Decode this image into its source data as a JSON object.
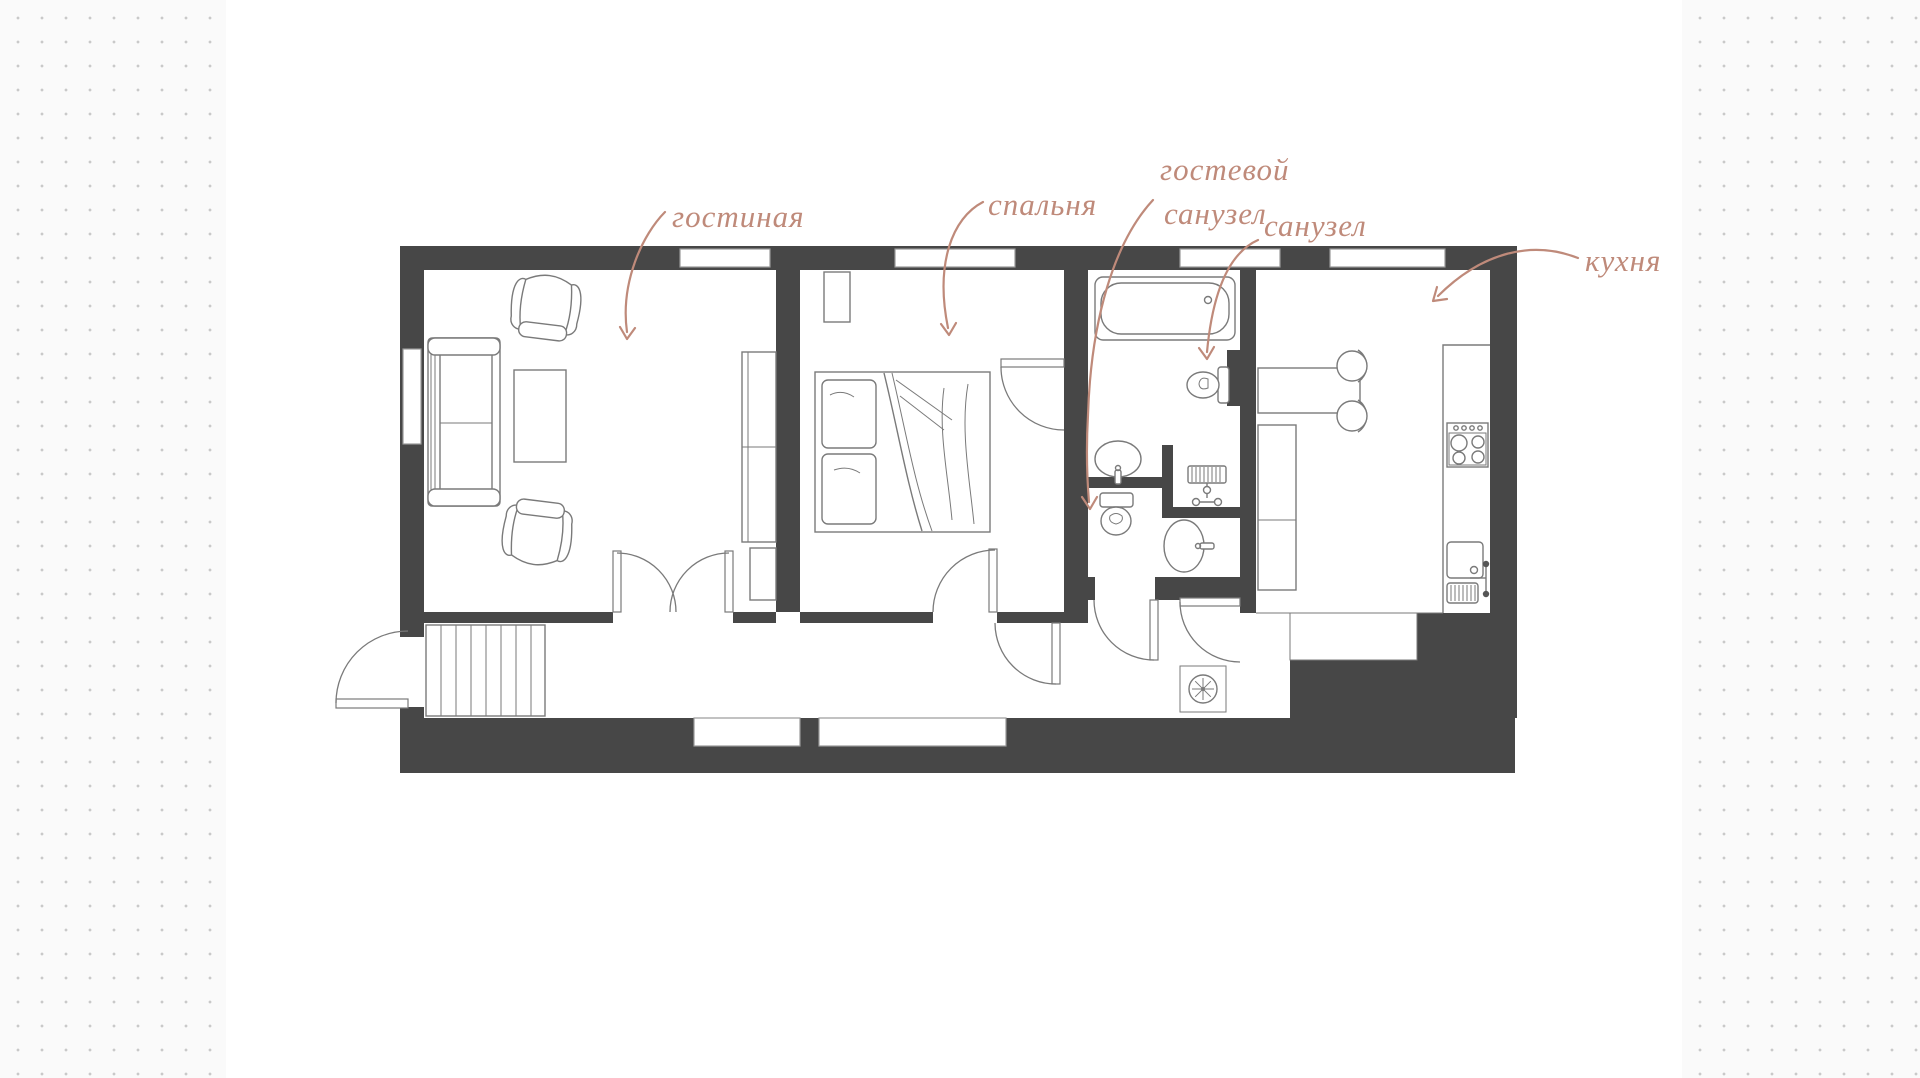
{
  "canvas": {
    "width": 1920,
    "height": 1078
  },
  "background": {
    "dot_color": "#c9c9c9",
    "side_band_bg": "#fafafa",
    "card_bg": "#ffffff"
  },
  "plan": {
    "colors": {
      "walls": "#474747",
      "furniture_lines": "#7a7a7a",
      "window_lines": "#9a9a9a",
      "accent": "#bf8a7a",
      "dots": "#c9c9c9",
      "card": "#ffffff"
    },
    "labels": [
      {
        "id": "living-room",
        "text": "гостиная"
      },
      {
        "id": "bedroom",
        "text": "спальня"
      },
      {
        "id": "guest-bathroom-line1",
        "text": "гостевой"
      },
      {
        "id": "guest-bathroom-line2",
        "text": "санузел"
      },
      {
        "id": "bathroom",
        "text": "санузел"
      },
      {
        "id": "kitchen",
        "text": "кухня"
      }
    ]
  }
}
